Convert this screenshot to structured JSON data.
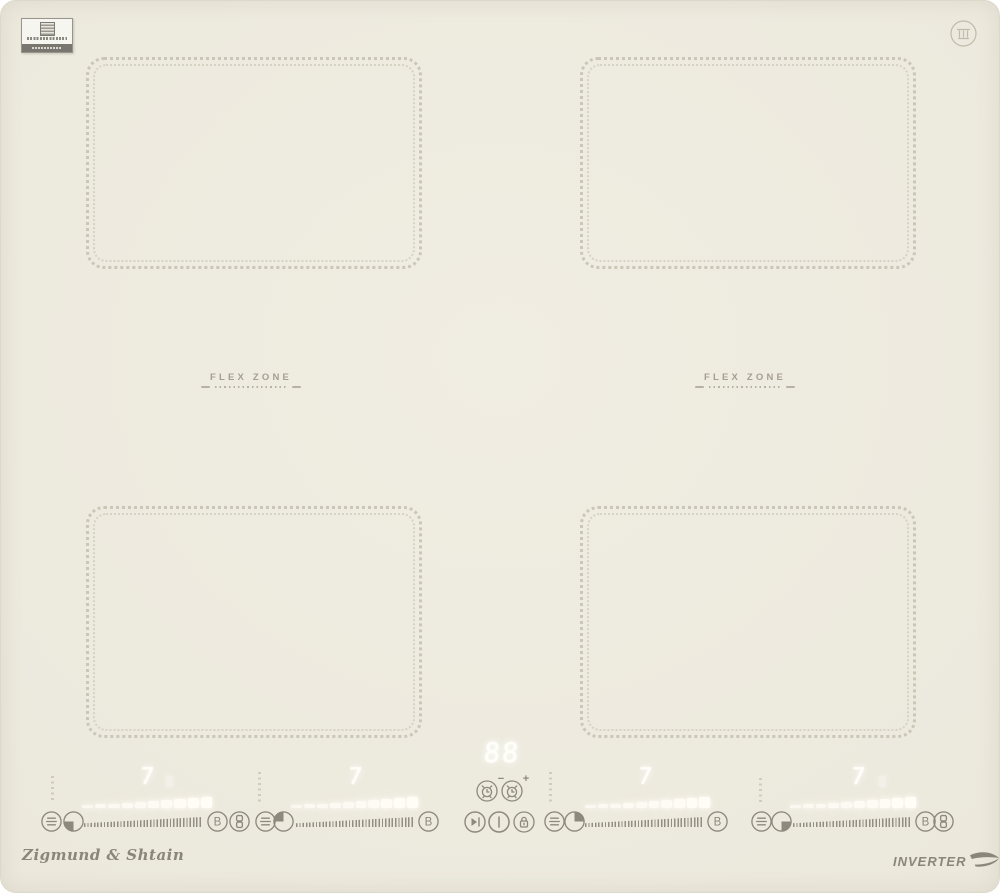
{
  "surface": {
    "flex_zone_label": "FLEX ZONE"
  },
  "branding": {
    "logo": "Zigmund & Shtain",
    "inverter": "INVERTER"
  },
  "center_controls": {
    "timer_display": "88",
    "timer_minus_sign": "−",
    "timer_plus_sign": "+"
  },
  "burners": [
    {
      "position": "front-left",
      "power": "7",
      "boost_label": "B"
    },
    {
      "position": "rear-left",
      "power": "7",
      "boost_label": "B"
    },
    {
      "position": "rear-right",
      "power": "7",
      "boost_label": "B"
    },
    {
      "position": "front-right",
      "power": "7",
      "boost_label": "B"
    }
  ],
  "icons": {
    "keep_warm": "keep-warm",
    "zone_timer": "zone-timer-quarter",
    "boost": "B",
    "bridge": "bridge-zones",
    "pause": "play-pause",
    "power": "on-off",
    "lock": "child-lock",
    "timer_clock": "alarm-clock"
  },
  "colors": {
    "glass": "#ece9dd",
    "zone_dots": "#cbc7b8",
    "icon_gray": "#8d897c",
    "label_gray": "#a59f90",
    "glow_white": "#ffffff"
  }
}
